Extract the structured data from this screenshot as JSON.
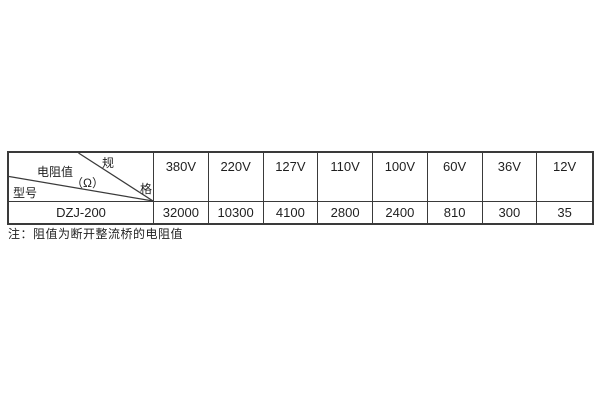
{
  "table": {
    "corner": {
      "spec_char_top": "规",
      "spec_char_bottom": "格",
      "resistance_label": "电阻值",
      "resistance_unit": "（Ω）",
      "model_label": "型号"
    },
    "columns": [
      "380V",
      "220V",
      "127V",
      "110V",
      "100V",
      "60V",
      "36V",
      "12V"
    ],
    "rows": [
      {
        "model": "DZJ-200",
        "values": [
          "32000",
          "10300",
          "4100",
          "2800",
          "2400",
          "810",
          "300",
          "35"
        ]
      }
    ]
  },
  "note": "注：阻值为断开整流桥的电阻值",
  "colors": {
    "background": "#ffffff",
    "border": "#3a3a3a",
    "text": "#1f1f1f"
  }
}
